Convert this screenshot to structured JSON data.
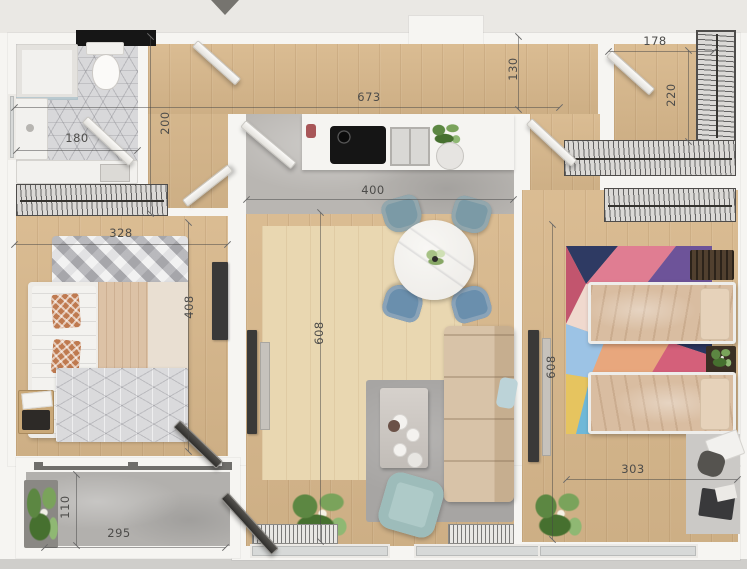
{
  "plan": {
    "title": "apartment-floor-plan",
    "dims": {
      "bathroom_width": "180",
      "hall_depth": "200",
      "corridor_length": "673",
      "corridor_depth": "130",
      "dressing_width": "178",
      "dressing_depth": "220",
      "bedroom1_width": "328",
      "bedroom1_depth": "408",
      "living_width": "400",
      "living_depth": "608",
      "bedroom2_depth": "608",
      "bedroom2_width": "303",
      "balcony_depth": "110",
      "balcony_width": "295"
    },
    "colors": {
      "wood_floor": "#d8b88c",
      "wood_rug": "#e9d7b1",
      "tile_floor": "#d8d8da",
      "concrete_floor": "#b9b6b2",
      "balcony_stone": "#b2b0ad",
      "wall": "#f6f5f2",
      "dining_chair_blue": "#7b9aa6",
      "sofa_beige": "#d8c3a8",
      "armchair_mint": "#aecac8",
      "living_rug_gray": "#a7a5a3",
      "kids_rug_pink": "#e07d92",
      "kids_rug_teal": "#66c4b4",
      "kids_rug_navy": "#2e3a63"
    }
  }
}
